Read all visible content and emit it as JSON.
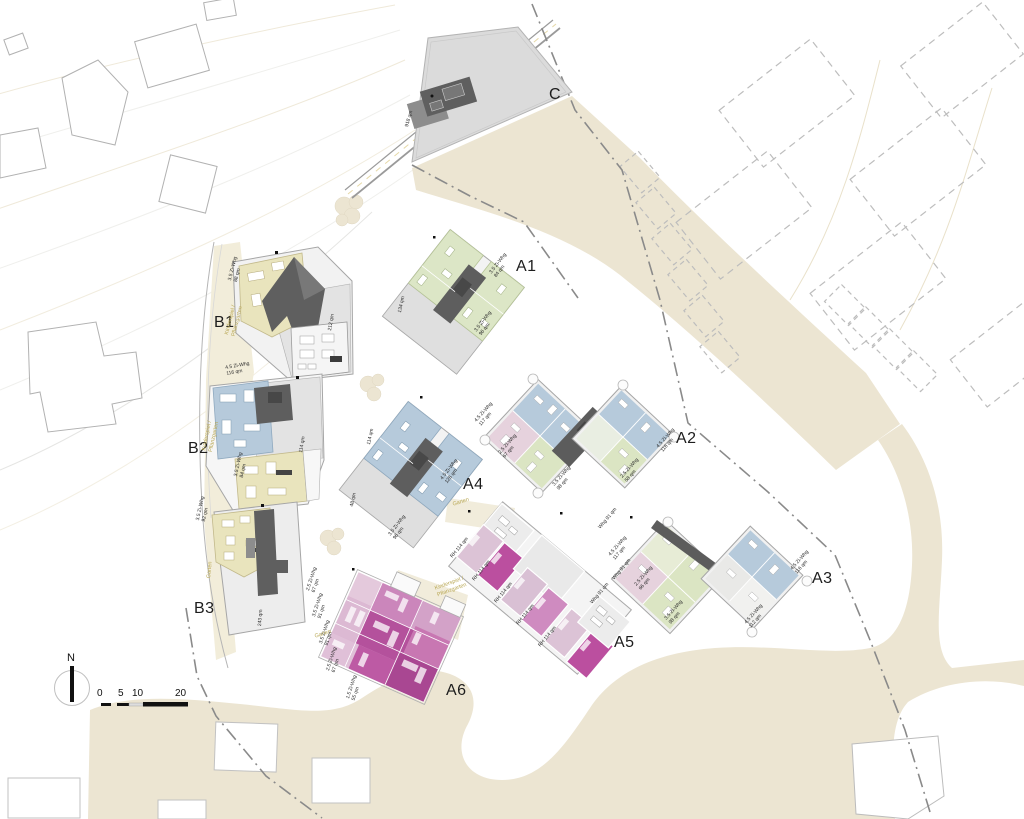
{
  "plan_type": "residential site plan",
  "building_labels": {
    "c": "C",
    "a1": "A1",
    "a2": "A2",
    "a3": "A3",
    "a4": "A4",
    "a5": "A5",
    "a6": "A6",
    "b1": "B1",
    "b2": "B2",
    "b3": "B3"
  },
  "north_label": "N",
  "scale_ticks": [
    "0",
    "5",
    "10",
    "20"
  ],
  "garden_labels": {
    "kinderspiel": "Kinderspiel / Pflanzgarten",
    "garten": "Garten"
  },
  "area_labels": {
    "c": "918 qm",
    "b1": "212 qm",
    "b2": "114 qm",
    "b3": "243 qm",
    "a1": "134 qm",
    "a4_upper": "114 qm",
    "a4_lower": "48 qm"
  },
  "unit_labels": {
    "w35_84": "3.5 Zi-Whg 84 qm",
    "w35_88": "3.5 Zi-Whg 88 qm",
    "w35_91": "3.5 Zi-Whg 91 qm",
    "w35_92": "3.5 Zi-Whg 92 qm",
    "w35_96": "3.5 Zi-Whg 96 qm",
    "w35_98": "3.5 Zi-Whg 98 qm",
    "w45_112": "4.5 Zi-Whg 112 qm",
    "w45_116": "4.5 Zi-Whg 116 qm",
    "w45_117": "4.5 Zi-Whg 117 qm",
    "w45_126": "4.5 Zi-Whg 126 qm",
    "w25_58": "2.5 Zi-Whg 58 qm",
    "w25_66": "2.5 Zi-Whg 66 qm",
    "w25_67": "2.5 Zi-Whg 67 qm",
    "w15_55": "1.5 Zi-Whg 55 qm",
    "rh_114": "RH 114 qm",
    "whg_91": "Whg 91 qm"
  },
  "colors": {
    "road_beige": "#ece5d2",
    "pale_strip": "#f2edda",
    "unit_blue": "#b6cadb",
    "unit_green": "#dbe5c3",
    "unit_yellow": "#e9e4bd",
    "unit_pink_pale": "#e6d2dd",
    "unit_magenta": "#b5539e",
    "unit_magenta_dark": "#ad4794",
    "core_gray": "#5e5e5e",
    "yard_gray": "#e3e3e3",
    "boundary_gray": "#8a8a8a",
    "olive_text": "#b9a855"
  }
}
